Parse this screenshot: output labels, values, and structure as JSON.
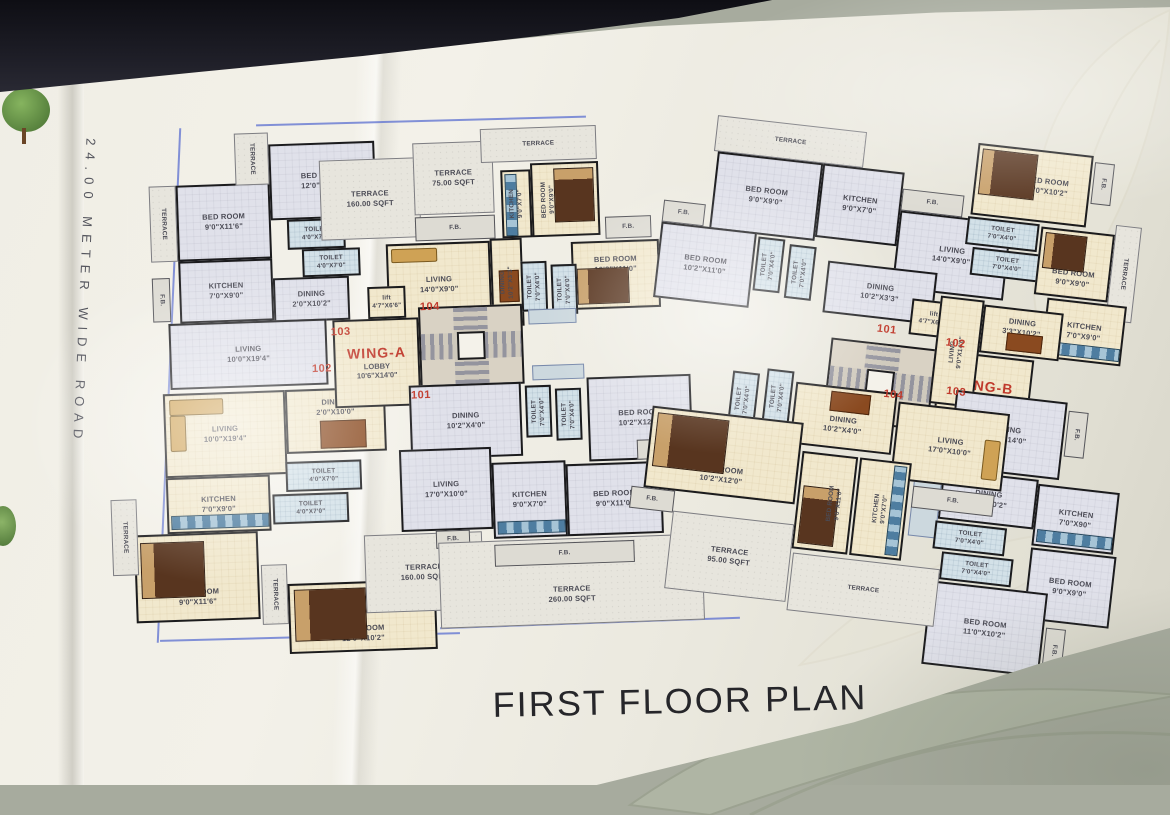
{
  "title": "FIRST FLOOR PLAN",
  "road_label": "24.00 METER WIDE ROAD",
  "colors": {
    "paper": "#efede3",
    "room_grey": "#e0e1ea",
    "room_cream": "#f1e8cd",
    "toilet_blue": "#d3e1e8",
    "wall": "#1b1b1d",
    "unit_number_red": "#c0392b",
    "terrace_fill": "#e7e5dd",
    "ink_blue": "#5b6fd0"
  },
  "wingA": {
    "name": "WING-A",
    "lobby": "LOBBY\n10'6\"X14'0\"",
    "lift": "lift\n4'7\"X6'6\"",
    "terrace160_top": "TERRACE\n160.00 SQFT",
    "terrace75": "TERRACE\n75.00 SQFT",
    "u103": {
      "num": "103",
      "terrace_side": "TERRACE",
      "terrace_top": "TERRACE",
      "fb": "F.B.",
      "bed1": "BED ROOM\n9'0\"X11'6\"",
      "bed2": "BED ROOM\n12'0\"X10'2\"",
      "toilet1": "TOILET\n4'0\"X7'0\"",
      "toilet2": "TOILET\n4'0\"X7'0\"",
      "kitchen": "KITCHEN\n7'0\"X9'0\"",
      "dining": "DINING\n2'0\"X10'2\"",
      "living": "LIVING\n10'0\"X19'4\""
    },
    "u102": {
      "num": "102",
      "living": "LIVING\n10'0\"X19'4\"",
      "dining": "DINING\n2'0\"X10'0\"",
      "kitchen": "KITCHEN\n7'0\"X9'0\"",
      "toilet1": "TOILET\n4'0\"X7'0\"",
      "toilet2": "TOILET\n4'0\"X7'0\"",
      "bed1": "BED ROOM\n9'0\"X11'6\"",
      "bed2": "BED ROOM\n12'0\"X10'2\"",
      "terrace_side": "TERRACE",
      "terrace_mid": "TERRACE",
      "terrace160": "TERRACE\n160.00 SQFT"
    },
    "u104": {
      "num": "104",
      "fb_top": "F.B.",
      "fb_right": "F.B.",
      "terrace_top": "TERRACE",
      "living": "LIVING\n14'0\"X9'0\"",
      "dining": "DINING\n10'2\"X3'3\"",
      "kitchen": "KITCHEN\n9'0\"X7'0\"",
      "bed1": "BED ROOM\n9'0\"X9'0\"",
      "bed2": "BED ROOM\n10'2\"X11'0\"",
      "toilet1": "TOILET\n7'0\"X4'0\"",
      "toilet2": "TOILET\n7'0\"X4'0\""
    },
    "u101": {
      "num": "101",
      "dining": "DINING\n10'2\"X4'0\"",
      "toilet1": "TOILET\n7'0\"X4'0\"",
      "toilet2": "TOILET\n7'0\"X4'0\"",
      "bed1": "BED ROOM\n10'2\"X12'0\"",
      "living": "LIVING\n17'0\"X10'0\"",
      "kitchen": "KITCHEN\n9'0\"X7'0\"",
      "bed2": "BED ROOM\n9'0\"X11'0\"",
      "fb_right": "F.B.",
      "fb_left": "F.B.",
      "fb_bottom": "F.B.",
      "terrace260": "TERRACE\n260.00 SQFT"
    }
  },
  "wingB": {
    "name": "WING-B",
    "lobby": "LOBBY\n11'6\"X10'6\"",
    "lift": "lift\n4'7\"X6'6\"",
    "u101": {
      "num": "101",
      "terrace_top": "TERRACE",
      "bed1": "BED ROOM\n9'0\"X9'0\"",
      "kitchen": "KITCHEN\n9'0\"X7'0\"",
      "fb1": "F.B.",
      "fb2": "F.B.",
      "living": "LIVING\n14'0\"X9'0\"",
      "dining": "DINING\n10'2\"X3'3\"",
      "bed2": "BED ROOM\n10'2\"X11'0\"",
      "toilet1": "TOILET\n7'0\"X4'0\"",
      "toilet2": "TOILET\n7'0\"X4'0\""
    },
    "u102": {
      "num": "102",
      "bed1": "BED ROOM\n11'0\"X10'2\"",
      "fb": "F.B.",
      "toilet1": "TOILET\n7'0\"X4'0\"",
      "toilet2": "TOILET\n7'0\"X4'0\"",
      "bed2": "BED ROOM\n9'0\"X9'0\"",
      "terrace_side": "TERRACE",
      "kitchen": "KITCHEN\n7'0\"X9'0\"",
      "dining": "DINING\n3'3\"X10'2\"",
      "living": "LIVING\n9'0\"X14'0\""
    },
    "u103": {
      "num": "103",
      "living": "LIVING\n9'0\"X14'0\"",
      "fb1": "F.B.",
      "fb2": "F.B.",
      "dining": "DINING\n3'3\"X10'2\"",
      "toilet1": "TOILET\n7'0\"X4'0\"",
      "toilet2": "TOILET\n7'0\"X4'0\"",
      "kitchen": "KITCHEN\n7'0\"X90\"",
      "bed1": "BED ROOM\n9'0\"X9'0\"",
      "bed2": "BED ROOM\n11'0\"X10'2\""
    },
    "u104": {
      "num": "104",
      "toilet1": "TOILET\n7'0\"X4'0\"",
      "toilet2": "TOILET\n7'0\"X4'0\"",
      "dining": "DINING\n10'2\"X4'0\"",
      "living": "LIVING\n17'0\"X10'0\"",
      "bed1": "BED ROOM\n10'2\"X12'0\"",
      "bed2": "BED ROOM\n9'0\"X11'0\"",
      "kitchen": "KITCHEN\n9'0\"X7'0\"",
      "fb1": "F.B.",
      "fb2": "F.B.",
      "terrace95": "TERRACE\n95.00 SQFT",
      "terrace": "TERRACE"
    }
  }
}
